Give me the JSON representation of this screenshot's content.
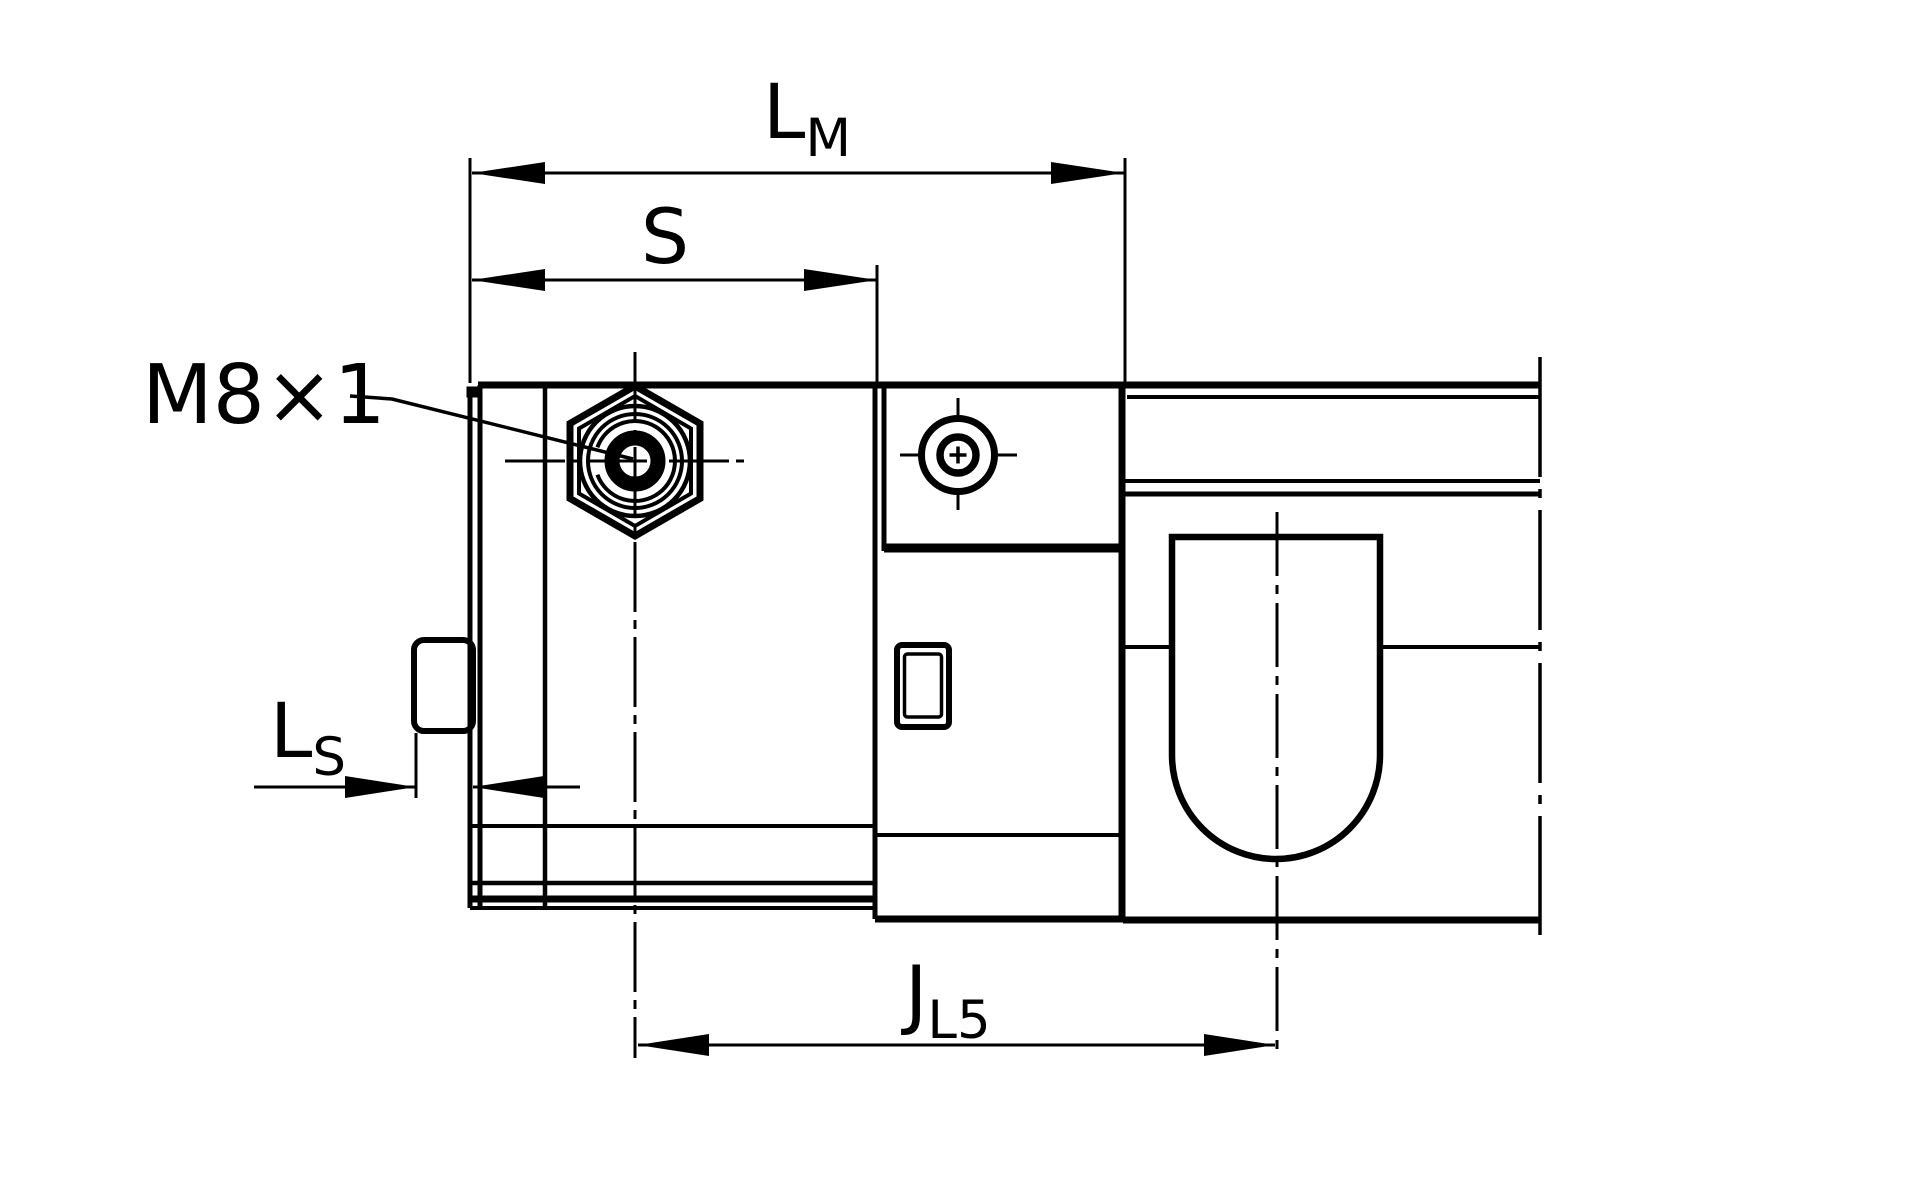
{
  "page": {
    "background": "#ffffff",
    "line_color": "#000000",
    "width": 1920,
    "height": 1200
  },
  "drawing": {
    "description": "Technical dimension drawing, side view of linear drive slide with grease nipple and sensor rail",
    "labels": {
      "dim_lm": {
        "main": "L",
        "sub": "M"
      },
      "dim_s": {
        "main": "S",
        "sub": ""
      },
      "dim_ls": {
        "main": "L",
        "sub": "S"
      },
      "dim_jl5": {
        "main": "J",
        "sub": "L5"
      },
      "thread_callout": "M8×1"
    }
  }
}
